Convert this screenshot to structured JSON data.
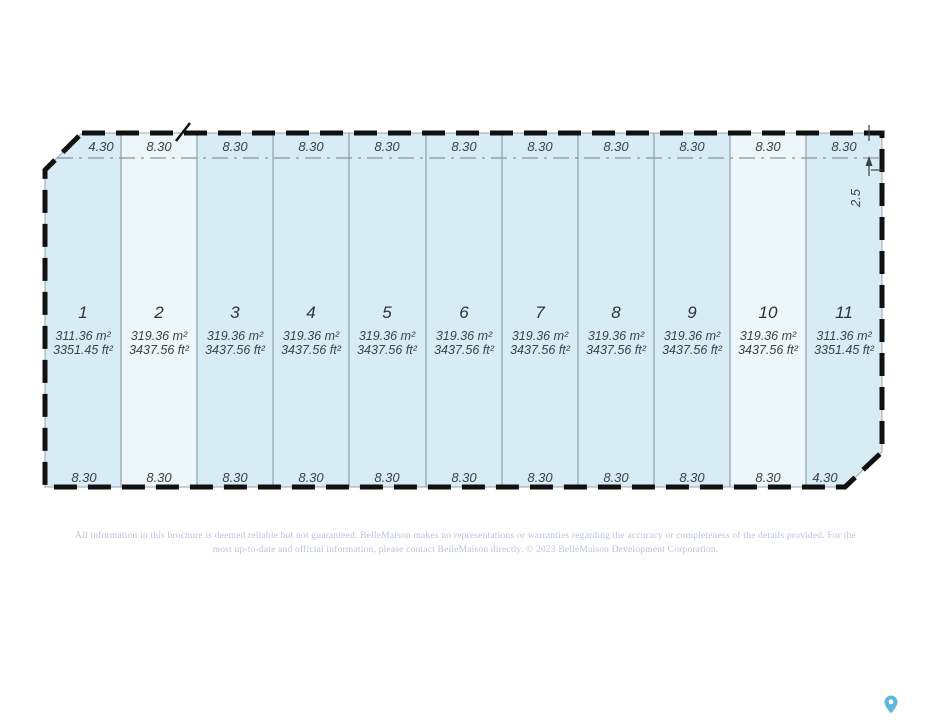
{
  "plan": {
    "setback_label": "2.5",
    "colors": {
      "lot_fill": "#d7ecf5",
      "lot_fill_light": "#edf6f9",
      "boundary": "#111111",
      "interior_line": "#90a0aa",
      "setback_line": "#8a9299",
      "dim_text": "#3c4248"
    },
    "lots": [
      {
        "number": "1",
        "top_dim": "4.30",
        "bottom_dim": "8.30",
        "area_m2": "311.36 m²",
        "area_ft2": "3351.45 ft²",
        "fill": "#d7ecf5"
      },
      {
        "number": "2",
        "top_dim": "8.30",
        "bottom_dim": "8.30",
        "area_m2": "319.36 m²",
        "area_ft2": "3437.56 ft²",
        "fill": "#edf6f9"
      },
      {
        "number": "3",
        "top_dim": "8.30",
        "bottom_dim": "8.30",
        "area_m2": "319.36 m²",
        "area_ft2": "3437.56 ft²",
        "fill": "#d7ecf5"
      },
      {
        "number": "4",
        "top_dim": "8.30",
        "bottom_dim": "8.30",
        "area_m2": "319.36 m²",
        "area_ft2": "3437.56 ft²",
        "fill": "#d7ecf5"
      },
      {
        "number": "5",
        "top_dim": "8.30",
        "bottom_dim": "8.30",
        "area_m2": "319.36 m²",
        "area_ft2": "3437.56 ft²",
        "fill": "#d7ecf5"
      },
      {
        "number": "6",
        "top_dim": "8.30",
        "bottom_dim": "8.30",
        "area_m2": "319.36 m²",
        "area_ft2": "3437.56 ft²",
        "fill": "#d7ecf5"
      },
      {
        "number": "7",
        "top_dim": "8.30",
        "bottom_dim": "8.30",
        "area_m2": "319.36 m²",
        "area_ft2": "3437.56 ft²",
        "fill": "#d7ecf5"
      },
      {
        "number": "8",
        "top_dim": "8.30",
        "bottom_dim": "8.30",
        "area_m2": "319.36 m²",
        "area_ft2": "3437.56 ft²",
        "fill": "#d7ecf5"
      },
      {
        "number": "9",
        "top_dim": "8.30",
        "bottom_dim": "8.30",
        "area_m2": "319.36 m²",
        "area_ft2": "3437.56 ft²",
        "fill": "#d7ecf5"
      },
      {
        "number": "10",
        "top_dim": "8.30",
        "bottom_dim": "8.30",
        "area_m2": "319.36 m²",
        "area_ft2": "3437.56 ft²",
        "fill": "#edf6f9"
      },
      {
        "number": "11",
        "top_dim": "8.30",
        "bottom_dim": "4.30",
        "area_m2": "311.36 m²",
        "area_ft2": "3351.45 ft²",
        "fill": "#d7ecf5"
      }
    ]
  },
  "footer": {
    "disclaimer_line1": "All information in this brochure is deemed reliable but not guaranteed. BelleMaison makes no representations or warranties regarding the accuracy or completeness of the details provided. For the",
    "disclaimer_line2": "most up-to-date and official information, please contact BelleMaison directly.   © 2023 BelleMaison Development Corporation."
  },
  "pin_color": "#5fb7db"
}
